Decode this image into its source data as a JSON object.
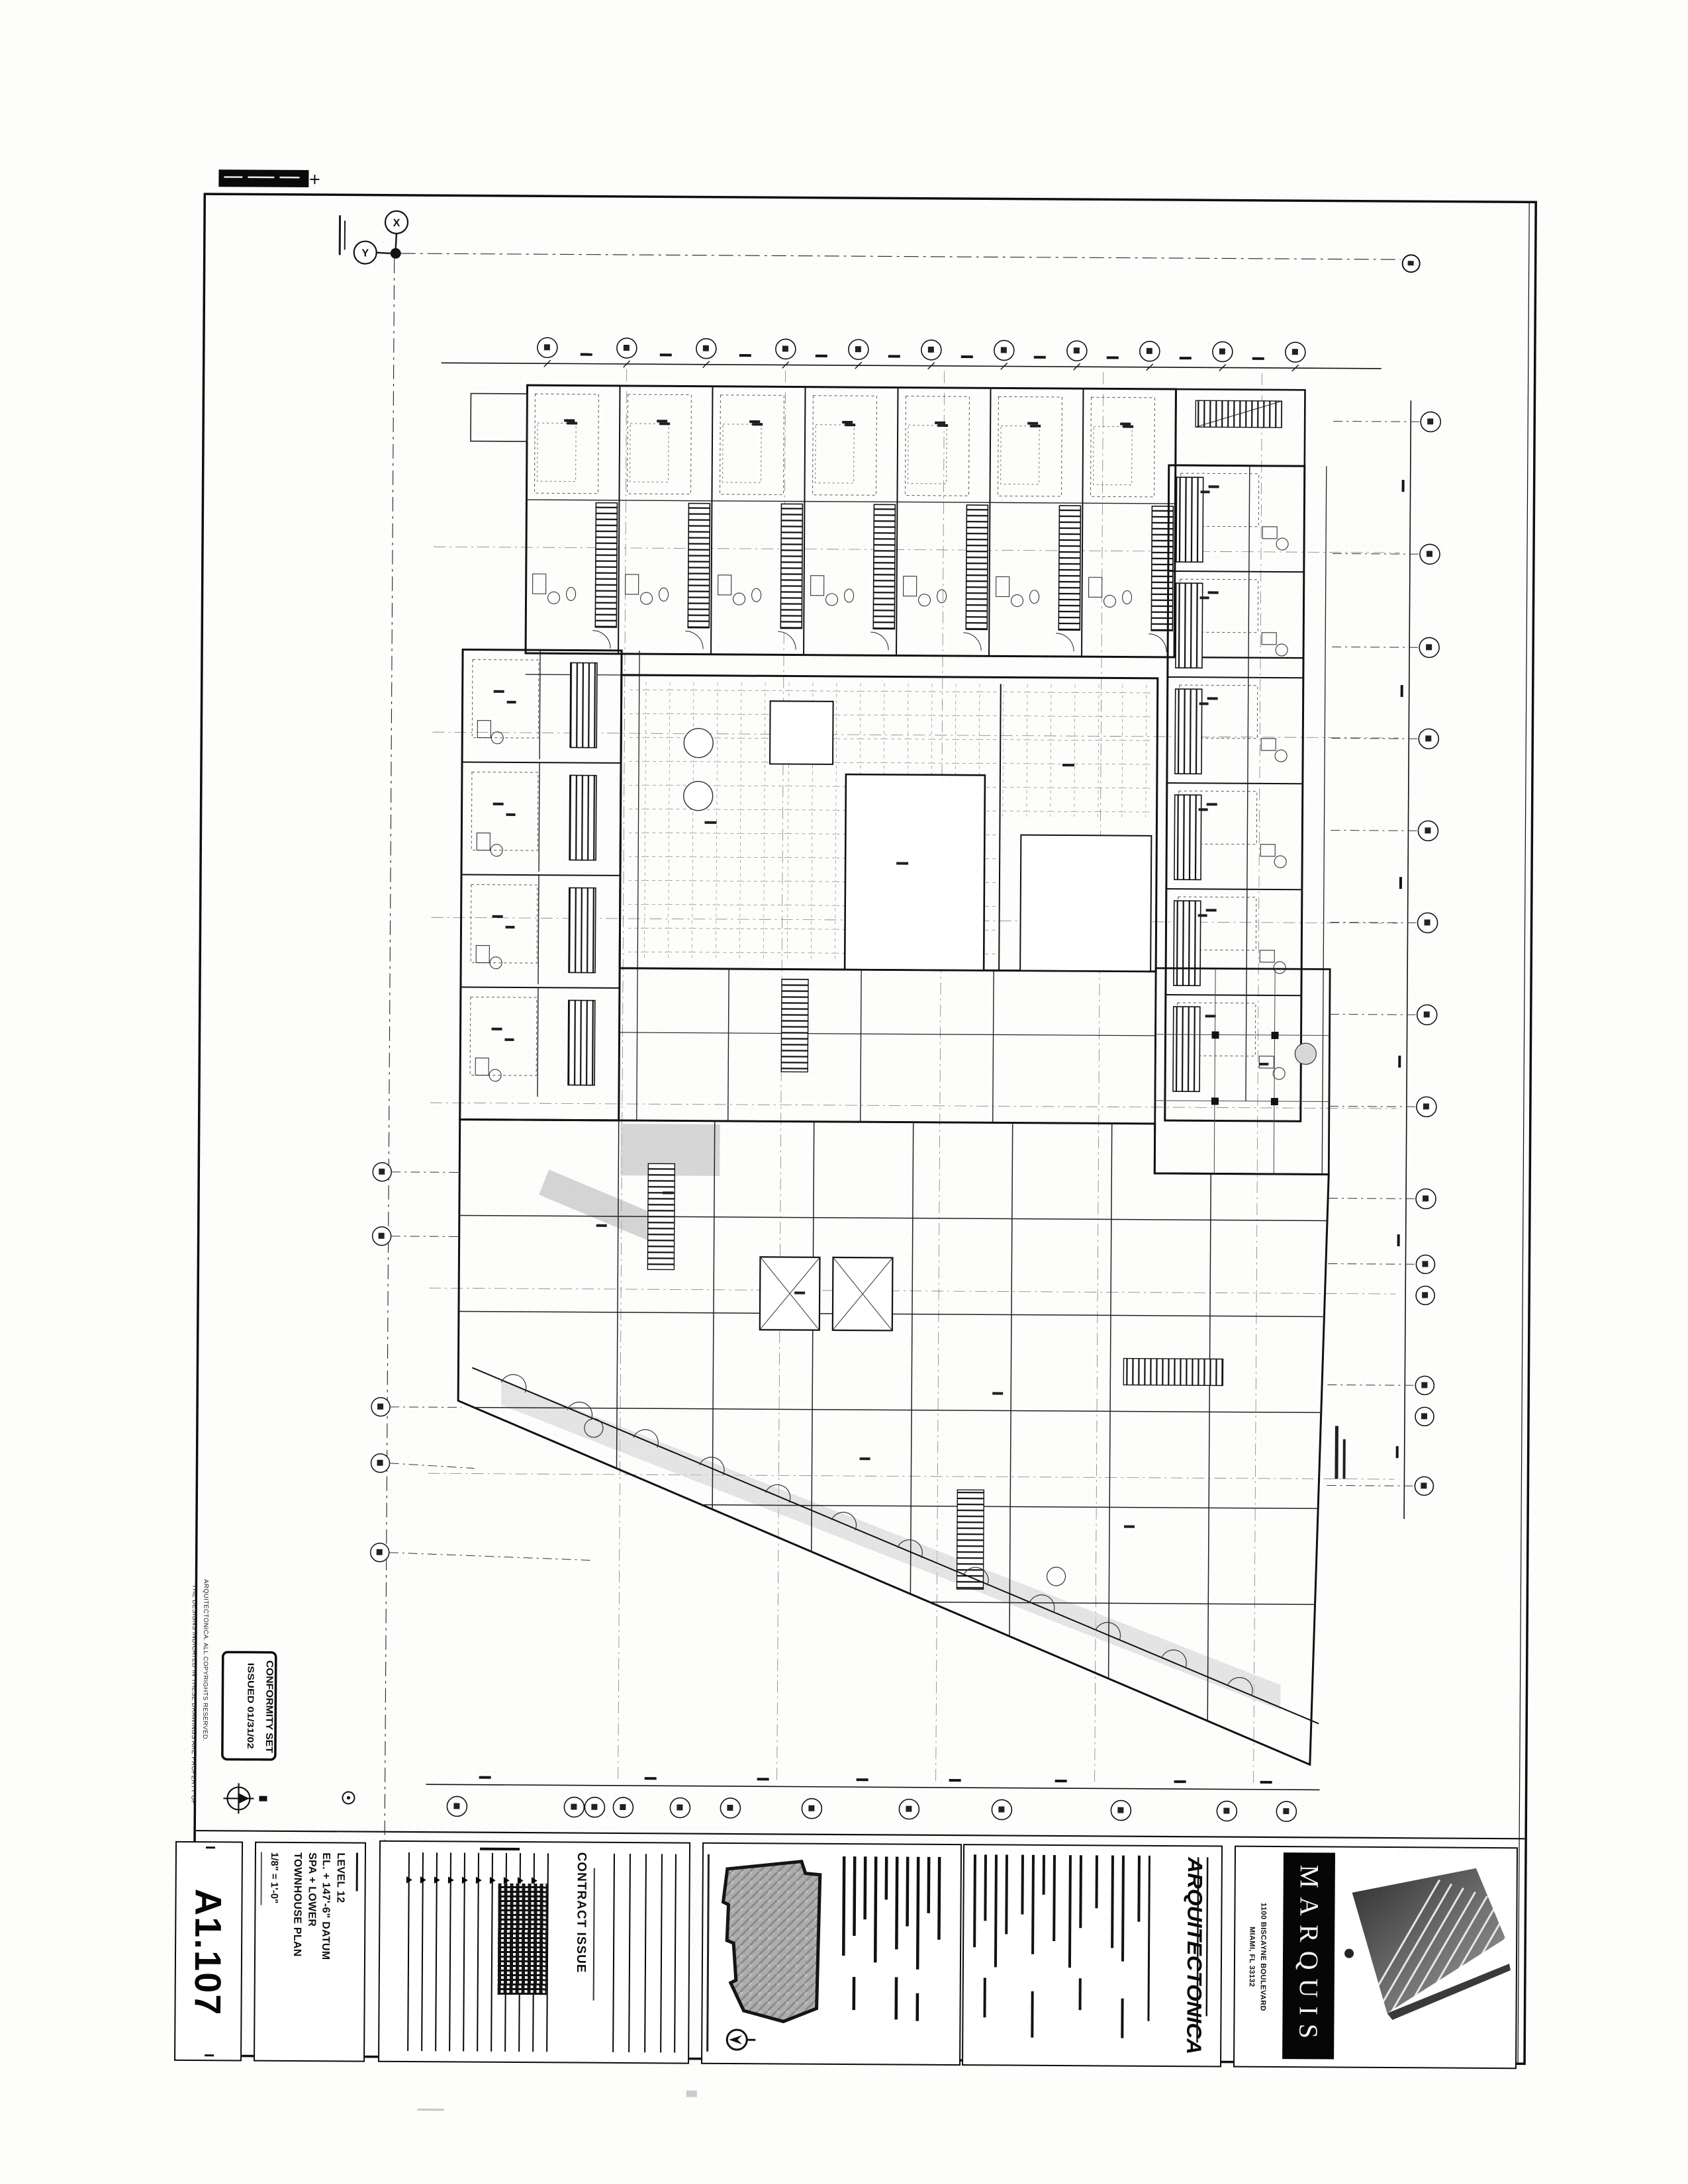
{
  "sheet": {
    "number": "A1.107",
    "title_lines": [
      "LEVEL 12",
      "EL. + 147'-6\" DATUM",
      "SPA + LOWER",
      "TOWNHOUSE PLAN"
    ],
    "scale": "1/8\" = 1'-0\"",
    "stamp": {
      "line1": "CONFORMITY SET",
      "line2": "ISSUED 01/31/02"
    },
    "issue": {
      "heading": "CONTRACT ISSUE"
    },
    "architect": {
      "name": "ARQUITECTONICA"
    },
    "project": {
      "name": "MARQUIS",
      "address_line1": "1100 BISCAYNE BOULEVARD",
      "address_line2": "MIAMI, FL 33132"
    },
    "datum": {
      "x_label": "X",
      "y_label": "Y"
    },
    "disclaimer_line1": "THE DESIGNS INDICATED IN THESE DRAWINGS ARE PROPERTY OF",
    "disclaimer_line2": "ARQUITECTONICA. ALL COPYRIGHTS RESERVED."
  }
}
